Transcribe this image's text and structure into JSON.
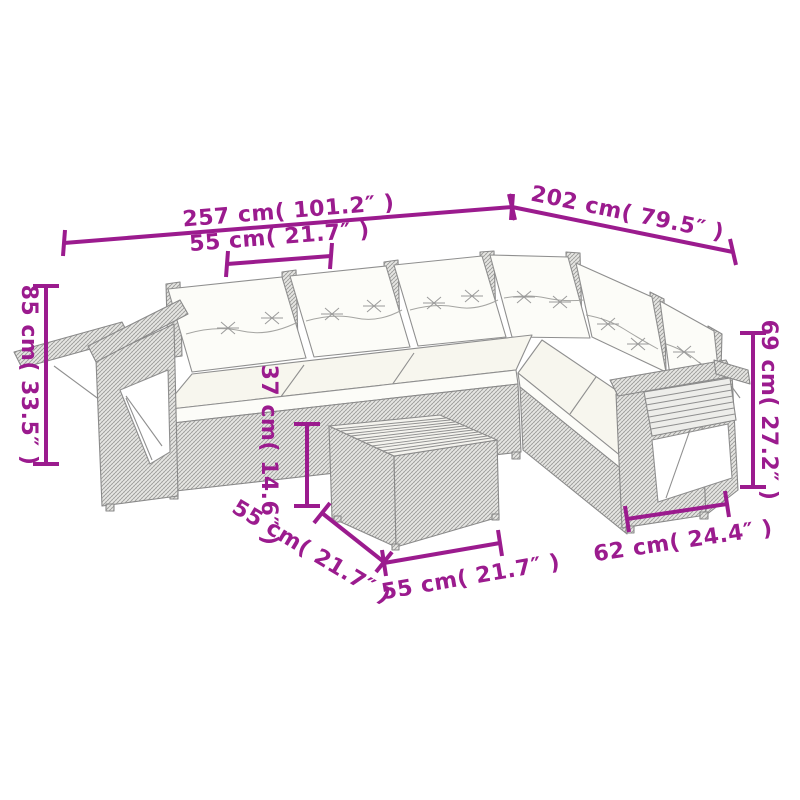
{
  "page": {
    "background": "#ffffff"
  },
  "diagram": {
    "accent_color": "#9B1B8E",
    "sketch_line_color": "#8f8f8f",
    "dimensions": {
      "total_width": {
        "label": "257 cm( 101.2″ )",
        "value_cm": 257,
        "value_inch": 101.2
      },
      "total_depth": {
        "label": "202 cm( 79.5″ )",
        "value_cm": 202,
        "value_inch": 79.5
      },
      "seat_width": {
        "label": "55 cm( 21.7″ )",
        "value_cm": 55,
        "value_inch": 21.7
      },
      "back_height": {
        "label": "85 cm( 33.5″ )",
        "value_cm": 85,
        "value_inch": 33.5
      },
      "arm_height": {
        "label": "69 cm( 27.2″ )",
        "value_cm": 69,
        "value_inch": 27.2
      },
      "table_height": {
        "label": "37 cm( 14.6″ )",
        "value_cm": 37,
        "value_inch": 14.6
      },
      "table_depth": {
        "label": "55 cm( 21.7″ )",
        "value_cm": 55,
        "value_inch": 21.7
      },
      "table_width": {
        "label": "55 cm( 21.7″ )",
        "value_cm": 55,
        "value_inch": 21.7
      },
      "section_depth": {
        "label": "62 cm( 24.4″ )",
        "value_cm": 62,
        "value_inch": 24.4
      }
    }
  }
}
